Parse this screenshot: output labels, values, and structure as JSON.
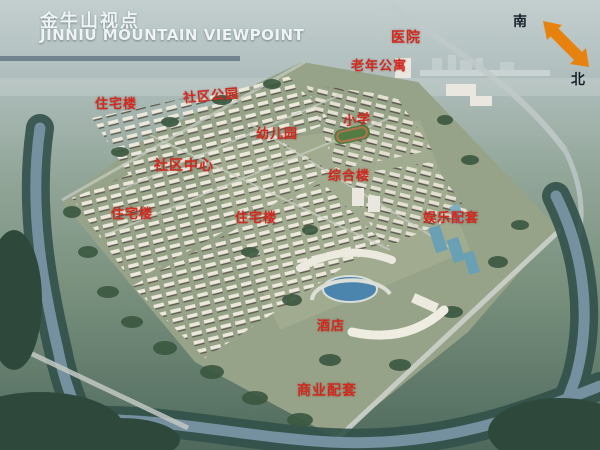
{
  "title": {
    "zh": "金牛山视点",
    "en": "JINNIU MOUNTAIN VIEWPOINT"
  },
  "compass": {
    "south": "南",
    "north": "北"
  },
  "labels": [
    {
      "text": "医院"
    },
    {
      "text": "老年公寓"
    },
    {
      "text": "社区公园"
    },
    {
      "text": "住宅楼"
    },
    {
      "text": "小学"
    },
    {
      "text": "幼儿园"
    },
    {
      "text": "社区中心"
    },
    {
      "text": "综合楼"
    },
    {
      "text": "住宅楼"
    },
    {
      "text": "住宅楼"
    },
    {
      "text": "娱乐配套"
    },
    {
      "text": "酒店"
    },
    {
      "text": "商业配套"
    }
  ],
  "colors": {
    "label_red": "#d5281e",
    "arrow_orange": "#e8820f",
    "title_white": "#eef3f4"
  }
}
